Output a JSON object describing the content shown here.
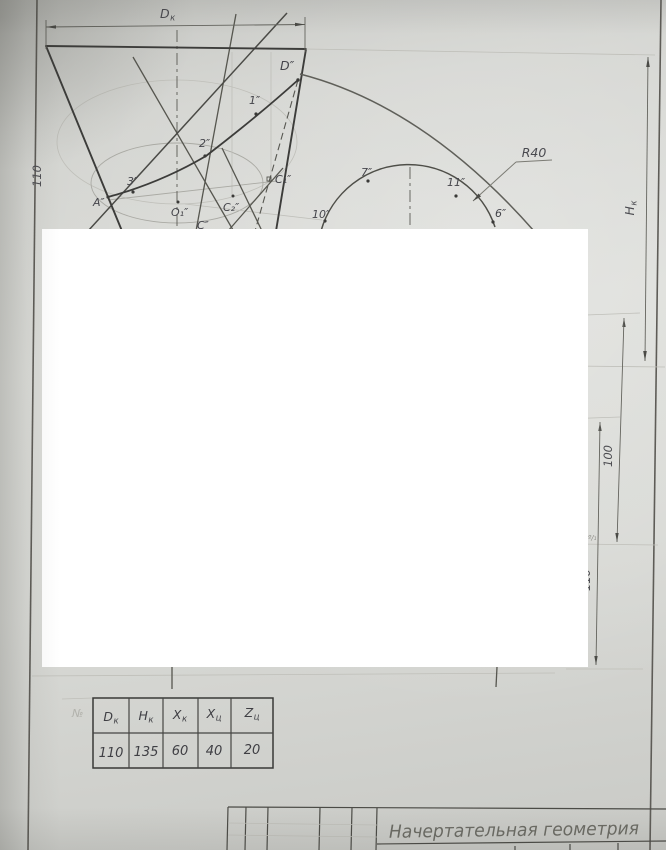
{
  "drawing": {
    "points": {
      "D": "D″",
      "p1": "1″",
      "p2": "2″",
      "p3": "3″",
      "A": "A″",
      "O1": "O₁″",
      "C2": "C₂″",
      "C1": "C₁″",
      "C": "C″",
      "p10": "10″",
      "p7": "7″",
      "p11": "11″",
      "p6": "6″"
    },
    "radius_label": "R40",
    "dimensions": {
      "dk": {
        "main": "D",
        "sub": "к"
      },
      "hk": {
        "main": "H",
        "sub": "к"
      },
      "left_height": "110",
      "right_100": "100",
      "right_110": "110",
      "fragment": "º/₁"
    }
  },
  "table": {
    "corner_note": "№",
    "headers": [
      {
        "main": "D",
        "sub": "к"
      },
      {
        "main": "H",
        "sub": "к"
      },
      {
        "main": "X",
        "sub": "к"
      },
      {
        "main": "X",
        "sub": "ц"
      },
      {
        "main": "Z",
        "sub": "ц"
      }
    ],
    "values": [
      "110",
      "135",
      "60",
      "40",
      "20"
    ]
  },
  "title_block": {
    "subject": "Начертательная геометрия"
  }
}
